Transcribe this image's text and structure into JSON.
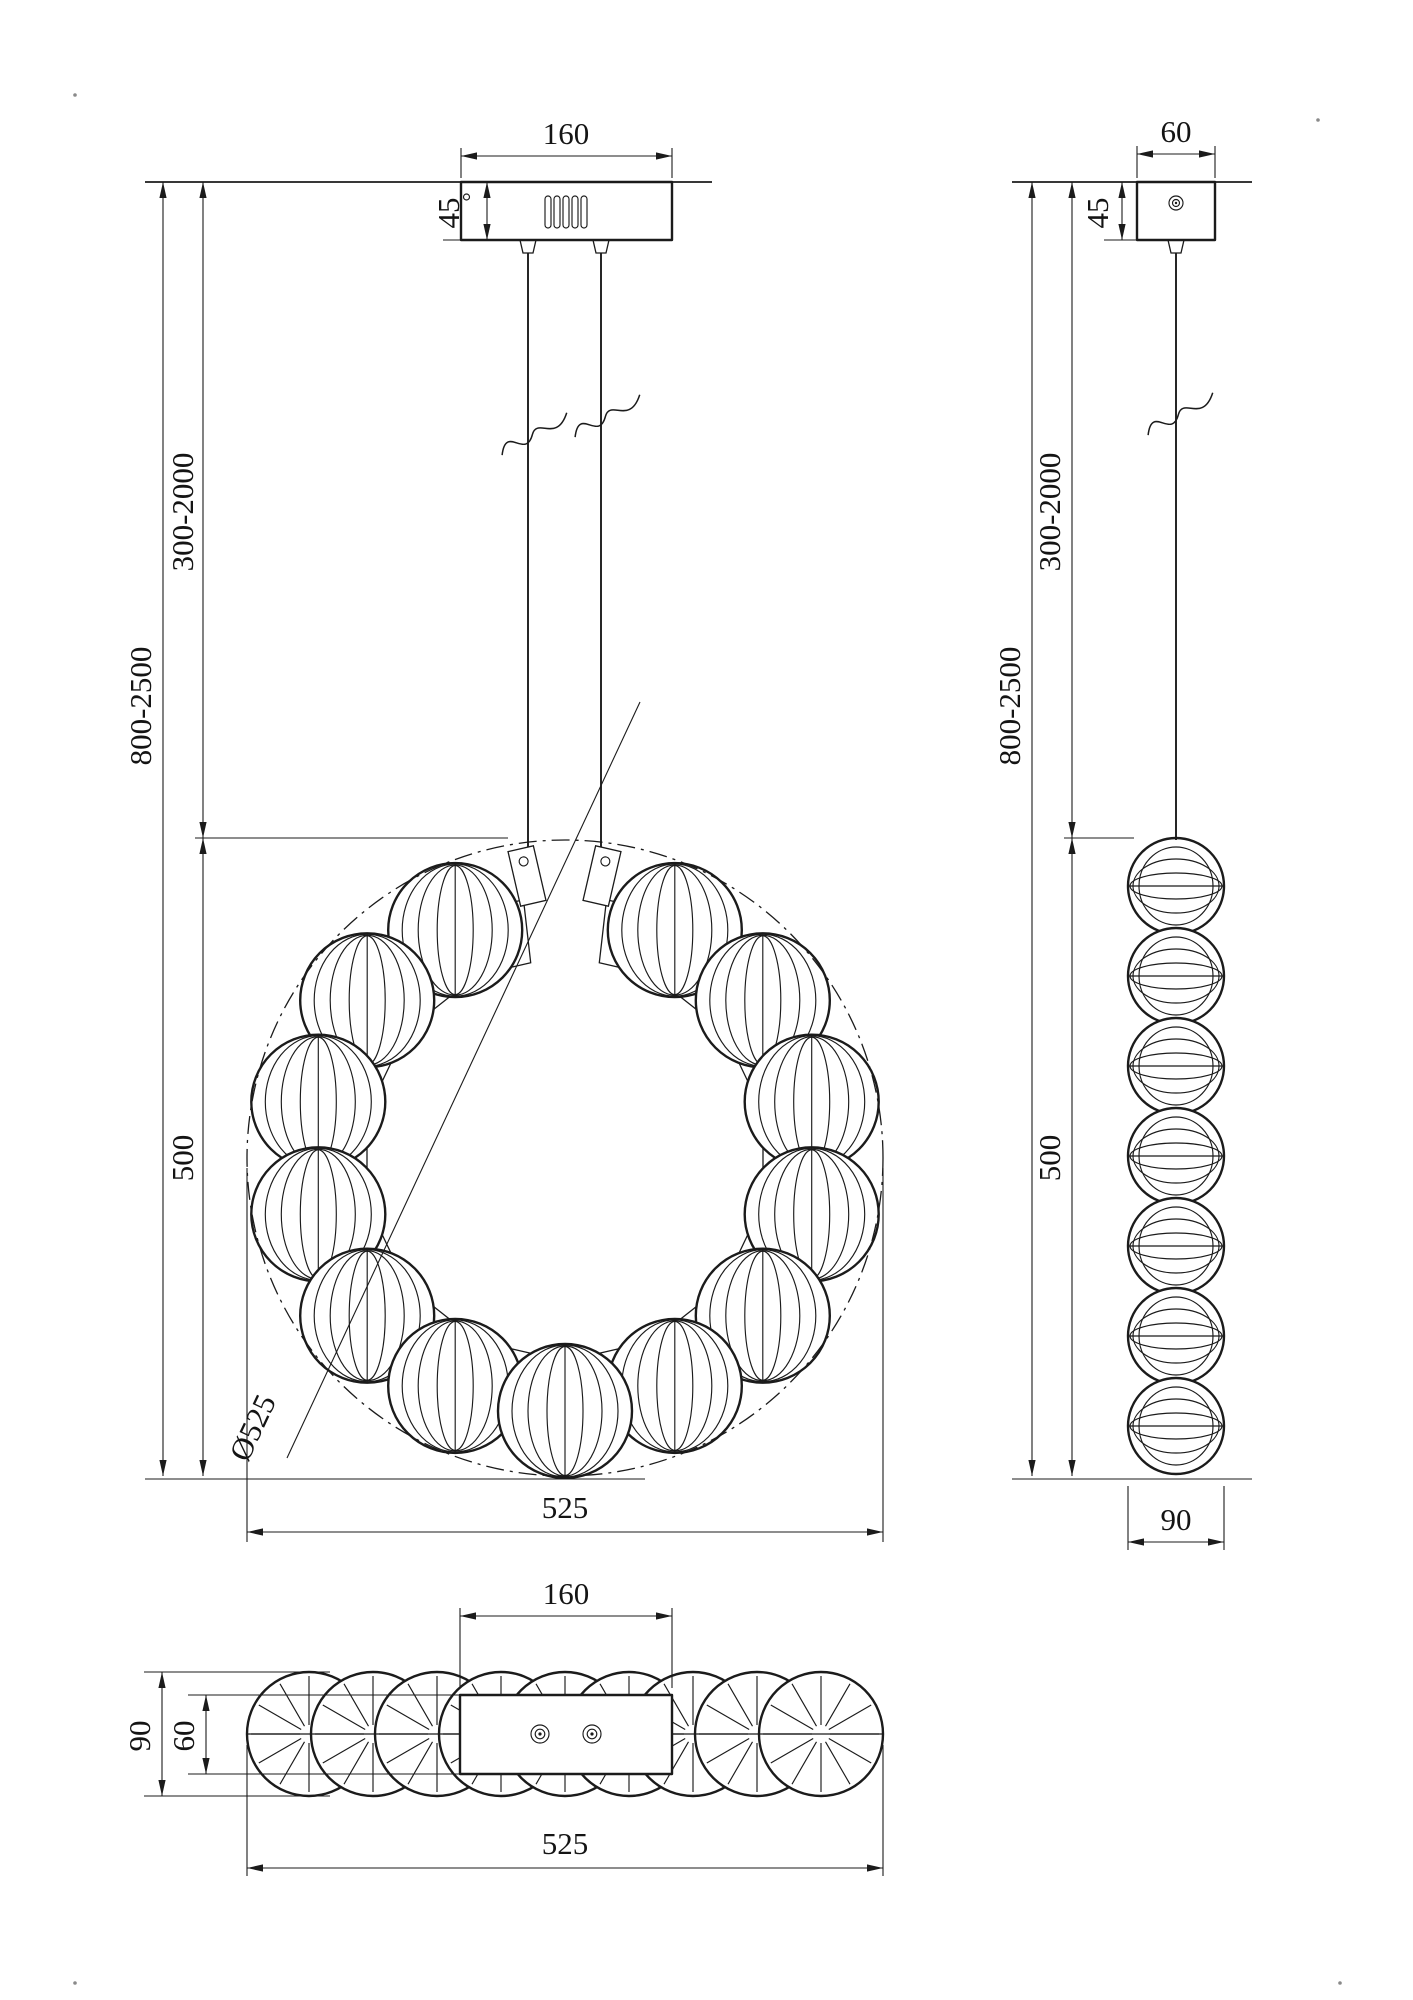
{
  "front_view": {
    "dims": {
      "canopy_width": "160",
      "canopy_height": "45",
      "suspension_length": "300-2000",
      "total_height": "800-2500",
      "body_height": "500",
      "diameter": "Ø525",
      "overall_width": "525"
    }
  },
  "side_view": {
    "dims": {
      "canopy_width": "60",
      "canopy_height": "45",
      "suspension_length": "300-2000",
      "total_height": "800-2500",
      "body_height": "500",
      "overall_depth": "90"
    }
  },
  "bottom_view": {
    "dims": {
      "plate_width": "160",
      "overall_depth": "90",
      "plate_depth": "60",
      "overall_width": "525"
    }
  }
}
